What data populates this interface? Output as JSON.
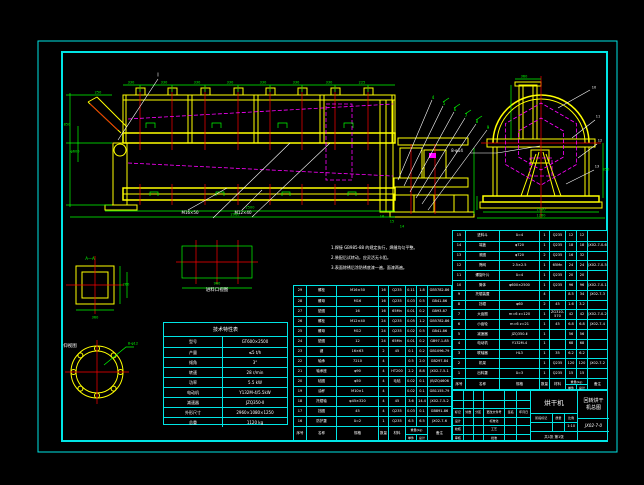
{
  "colors": {
    "frame": "#00e5e5",
    "line_main": "#ffff00",
    "dims": "#00ff00",
    "center": "#ff0000",
    "hidden": "#ff00ff",
    "leader": "#ffffff",
    "text": "#ffffff"
  },
  "notes": {
    "lines": [
      "1.焊接 GB985-88 的规定执行，焊缝均匀平整。",
      "2.装配后试转动，应灵活无卡阻。",
      "3.表面除锈后涂防锈底漆一遍，面漆两遍。"
    ]
  },
  "tech_table": {
    "title": "技术特性表",
    "rows": [
      [
        "型号",
        "GT600×2500"
      ],
      [
        "产量",
        "≤5 t/h"
      ],
      [
        "倾角",
        "3°"
      ],
      [
        "转速",
        "28 r/min"
      ],
      [
        "功率",
        "5.5 kW"
      ],
      [
        "电动机",
        "Y132M-4/5.5kW"
      ],
      [
        "减速器",
        "JZQ350-Ⅱ"
      ],
      [
        "外形尺寸",
        "2960×1080×1250"
      ],
      [
        "总重",
        "1120 kg"
      ]
    ]
  },
  "bom_headers": {
    "no": "序号",
    "name": "名称",
    "spec": "规格",
    "qty": "数量",
    "mat": "材料",
    "w1": "单件",
    "w2": "总计",
    "weight": "重量(kg)",
    "remark": "备注"
  },
  "bom_left": {
    "rows": [
      [
        "29",
        "螺栓",
        "M16×50",
        "16",
        "Q235",
        "0.11",
        "1.8",
        "GB5782-86"
      ],
      [
        "28",
        "螺母",
        "M16",
        "16",
        "Q235",
        "0.03",
        "0.5",
        "GB41-86"
      ],
      [
        "27",
        "垫圈",
        "16",
        "16",
        "65Mn",
        "0.01",
        "0.2",
        "GB93-87"
      ],
      [
        "26",
        "螺栓",
        "M12×40",
        "24",
        "Q235",
        "0.05",
        "1.2",
        "GB5782-86"
      ],
      [
        "25",
        "螺母",
        "M12",
        "24",
        "Q235",
        "0.02",
        "0.5",
        "GB41-86"
      ],
      [
        "24",
        "垫圈",
        "12",
        "24",
        "65Mn",
        "0.01",
        "0.2",
        "GB97.1-85"
      ],
      [
        "23",
        "键",
        "16×63",
        "2",
        "45",
        "0.1",
        "0.2",
        "GB1096-79"
      ],
      [
        "22",
        "轴承",
        "7210",
        "4",
        "",
        "0.5",
        "2.0",
        "GB297-84"
      ],
      [
        "21",
        "轴承座",
        "φ90",
        "4",
        "HT200",
        "2.2",
        "8.8",
        "JX02-7-5-1"
      ],
      [
        "20",
        "毡圈",
        "φ50",
        "4",
        "毛毡",
        "0.02",
        "0.1",
        "JB/ZQ4606"
      ],
      [
        "19",
        "油杯",
        "M10×1",
        "4",
        "",
        "0.02",
        "0.1",
        "GB1155-79"
      ],
      [
        "18",
        "托辊轴",
        "φ45×320",
        "4",
        "45",
        "3.6",
        "14.4",
        "JX02-7-5-2"
      ],
      [
        "17",
        "挡圈",
        "45",
        "4",
        "Q235",
        "0.03",
        "0.1",
        "GB891-86"
      ],
      [
        "16",
        "防护罩",
        "δ=2",
        "1",
        "Q235",
        "6.5",
        "6.5",
        "JX02-7-6"
      ]
    ]
  },
  "bom_right": {
    "rows": [
      [
        "15",
        "进料斗",
        "δ=4",
        "1",
        "Q235",
        "12",
        "12",
        ""
      ],
      [
        "14",
        "端盖",
        "φ720",
        "1",
        "Q235",
        "18",
        "18",
        "JX02-7-0-6"
      ],
      [
        "13",
        "滚圈",
        "φ720",
        "2",
        "Q235",
        "16",
        "32",
        ""
      ],
      [
        "12",
        "筛网",
        "2.5×2.5",
        "1",
        "65Mn",
        "24",
        "24",
        "JX02-7-0-5"
      ],
      [
        "11",
        "螺旋叶片",
        "δ=4",
        "1",
        "Q235",
        "20",
        "20",
        ""
      ],
      [
        "10",
        "筒体",
        "φ600×2500",
        "1",
        "Q235",
        "96",
        "96",
        "JX02-7-0-1"
      ],
      [
        "9",
        "托辊装置",
        "",
        "4",
        "",
        "8.5",
        "34",
        "JX02-7-3"
      ],
      [
        "8",
        "挡辊",
        "φ60",
        "2",
        "45",
        "1.6",
        "3.2",
        ""
      ],
      [
        "7",
        "大齿圈",
        "m=6 z=120",
        "1",
        "ZG310-570",
        "42",
        "42",
        "JX02-7-0-2"
      ],
      [
        "6",
        "小齿轮",
        "m=6 z=21",
        "1",
        "45",
        "6.8",
        "6.8",
        "JX02-7-4"
      ],
      [
        "5",
        "减速器",
        "JZQ350-Ⅱ",
        "1",
        "",
        "56",
        "56",
        ""
      ],
      [
        "4",
        "电动机",
        "Y132M-4",
        "1",
        "",
        "68",
        "68",
        ""
      ],
      [
        "3",
        "联轴器",
        "HL3",
        "1",
        "35",
        "6.2",
        "6.2",
        ""
      ],
      [
        "2",
        "机架",
        "",
        "1",
        "Q235",
        "120",
        "120",
        "JX02-7-2"
      ],
      [
        "1",
        "出料罩",
        "δ=3",
        "1",
        "Q235",
        "15",
        "15",
        ""
      ]
    ]
  },
  "title_block": {
    "product_name": "烘干机",
    "drawing_title_line1": "回转烘干",
    "drawing_title_line2": "机总图",
    "drawing_no": "JX02-7-0",
    "stage_label": "阶段标记",
    "mass_label": "质量",
    "scale_label": "比例",
    "scale": "1:10",
    "sheet_info": "共1张 第1张",
    "sig_rows": [
      [
        "",
        "",
        "",
        "",
        "",
        ""
      ],
      [
        "",
        "",
        "",
        "",
        "",
        ""
      ],
      [
        "标记",
        "处数",
        "分区",
        "更改文件号",
        "签名",
        "年月日"
      ],
      [
        "设计",
        "",
        "",
        "标准化",
        "",
        ""
      ],
      [
        "校核",
        "",
        "",
        "工艺",
        "",
        ""
      ],
      [
        "审核",
        "",
        "",
        "批准",
        "",
        ""
      ]
    ]
  },
  "view_labels": {
    "top_detail": "进料口视图",
    "flange_view": "仰视图",
    "square_section": "A—A",
    "detail_mark": "Ⅰ"
  },
  "svg_labels": [
    {
      "x": 131,
      "y": 83,
      "t": "330",
      "c": "#00ff00",
      "s": 3.5
    },
    {
      "x": 164,
      "y": 83,
      "t": "330",
      "c": "#00ff00",
      "s": 3.5
    },
    {
      "x": 197,
      "y": 83,
      "t": "330",
      "c": "#00ff00",
      "s": 3.5
    },
    {
      "x": 230,
      "y": 83,
      "t": "330",
      "c": "#00ff00",
      "s": 3.5
    },
    {
      "x": 263,
      "y": 83,
      "t": "330",
      "c": "#00ff00",
      "s": 3.5
    },
    {
      "x": 296,
      "y": 83,
      "t": "330",
      "c": "#00ff00",
      "s": 3.5
    },
    {
      "x": 329,
      "y": 83,
      "t": "330",
      "c": "#00ff00",
      "s": 3.5
    },
    {
      "x": 362,
      "y": 83,
      "t": "225",
      "c": "#00ff00",
      "s": 3.5
    },
    {
      "x": 98,
      "y": 93,
      "t": "250",
      "c": "#00ff00",
      "s": 3.5
    },
    {
      "x": 67,
      "y": 125,
      "t": "850",
      "c": "#00ff00",
      "s": 3.5
    },
    {
      "x": 75,
      "y": 152,
      "t": "φ600",
      "c": "#00ff00",
      "s": 3.5
    },
    {
      "x": 250,
      "y": 208,
      "t": "2500",
      "c": "#00ff00",
      "s": 3.5
    },
    {
      "x": 235,
      "y": 215,
      "t": "2960",
      "c": "#00ff00",
      "s": 3.5
    },
    {
      "x": 541,
      "y": 210,
      "t": "1080",
      "c": "#00ff00",
      "s": 3.5
    },
    {
      "x": 541,
      "y": 216,
      "t": "1260",
      "c": "#00ff00",
      "s": 3.5
    },
    {
      "x": 524,
      "y": 77,
      "t": "360",
      "c": "#00ff00",
      "s": 3.5
    },
    {
      "x": 606,
      "y": 170,
      "t": "850",
      "c": "#00ff00",
      "s": 3.5
    },
    {
      "x": 158,
      "y": 76,
      "t": "Ⅰ",
      "c": "#ffffff",
      "s": 5
    },
    {
      "x": 190,
      "y": 213,
      "t": "M16×50",
      "c": "#ffffff",
      "s": 4
    },
    {
      "x": 243,
      "y": 213,
      "t": "M12×40",
      "c": "#ffffff",
      "s": 4
    },
    {
      "x": 457,
      "y": 151,
      "t": "8-φ14",
      "c": "#ffffff",
      "s": 4
    },
    {
      "x": 433,
      "y": 98,
      "t": "4",
      "c": "#00ff00",
      "s": 4
    },
    {
      "x": 444,
      "y": 104,
      "t": "5",
      "c": "#00ff00",
      "s": 4
    },
    {
      "x": 455,
      "y": 110,
      "t": "6",
      "c": "#00ff00",
      "s": 4
    },
    {
      "x": 466,
      "y": 116,
      "t": "7",
      "c": "#00ff00",
      "s": 4
    },
    {
      "x": 477,
      "y": 122,
      "t": "8",
      "c": "#00ff00",
      "s": 4
    },
    {
      "x": 488,
      "y": 128,
      "t": "9",
      "c": "#00ff00",
      "s": 4
    },
    {
      "x": 382,
      "y": 217,
      "t": "16",
      "c": "#00ff00",
      "s": 3.5
    },
    {
      "x": 392,
      "y": 222,
      "t": "15",
      "c": "#00ff00",
      "s": 3.5
    },
    {
      "x": 402,
      "y": 227,
      "t": "14",
      "c": "#00ff00",
      "s": 3.5
    },
    {
      "x": 594,
      "y": 88,
      "t": "10",
      "c": "#ffffff",
      "s": 3.5
    },
    {
      "x": 598,
      "y": 117,
      "t": "11",
      "c": "#ffffff",
      "s": 3.5
    },
    {
      "x": 600,
      "y": 141,
      "t": "12",
      "c": "#ffffff",
      "s": 3.5
    },
    {
      "x": 597,
      "y": 167,
      "t": "13",
      "c": "#ffffff",
      "s": 3.5
    },
    {
      "x": 90,
      "y": 259,
      "t": "A—A",
      "c": "#00ff00",
      "s": 4
    },
    {
      "x": 95,
      "y": 318,
      "t": "360",
      "c": "#00ff00",
      "s": 3.5
    },
    {
      "x": 126,
      "y": 285,
      "t": "260",
      "c": "#00ff00",
      "s": 3.5
    },
    {
      "x": 133,
      "y": 344,
      "t": "8-φ12",
      "c": "#00ff00",
      "s": 3.5
    },
    {
      "x": 217,
      "y": 284,
      "t": "960",
      "c": "#00ff00",
      "s": 3.5
    },
    {
      "x": 70,
      "y": 347,
      "t": "仰视图",
      "c": "#ffffff",
      "s": 4.5
    },
    {
      "x": 217,
      "y": 291,
      "t": "进料口视图",
      "c": "#ffffff",
      "s": 4.5
    }
  ]
}
